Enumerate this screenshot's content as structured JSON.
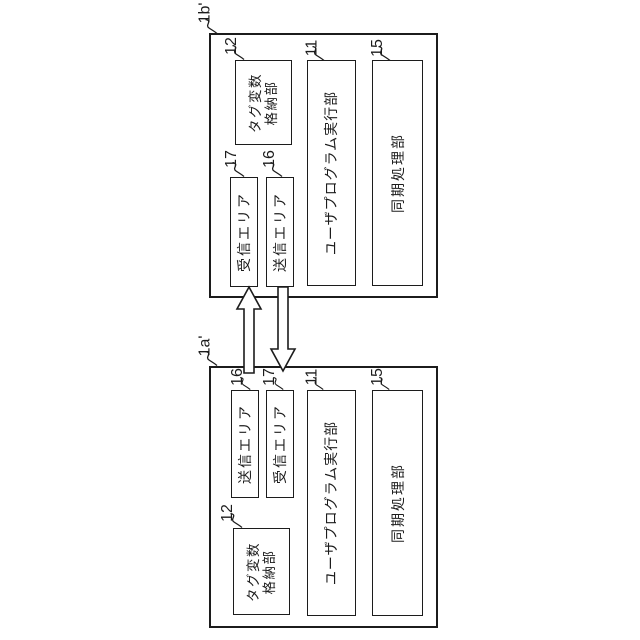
{
  "figure": {
    "type": "patent-block-diagram",
    "background_color": "#ffffff",
    "line_color": "#1c1c1c"
  },
  "systems": [
    {
      "ref_label": "1b'",
      "blocks": {
        "tag_storage": {
          "ref": "12",
          "line1": "タグ変数",
          "line2": "格納部"
        },
        "receive_area": {
          "ref": "17",
          "label": "受信エリア"
        },
        "send_area": {
          "ref": "16",
          "label": "送信エリア"
        },
        "program_exec": {
          "ref": "11",
          "label": "ユーザプログラム実行部"
        },
        "sync_proc": {
          "ref": "15",
          "label": "同期処理部"
        }
      }
    },
    {
      "ref_label": "1a'",
      "blocks": {
        "send_area": {
          "ref": "16",
          "label": "送信エリア"
        },
        "receive_area": {
          "ref": "17",
          "label": "受信エリア"
        },
        "tag_storage": {
          "ref": "12",
          "line1": "タグ変数",
          "line2": "格納部"
        },
        "program_exec": {
          "ref": "11",
          "label": "ユーザプログラム実行部"
        },
        "sync_proc": {
          "ref": "15",
          "label": "同期処理部"
        }
      }
    }
  ],
  "arrows": [
    {
      "name": "send-1a-to-receive-1b",
      "direction": "up"
    },
    {
      "name": "send-1b-to-receive-1a",
      "direction": "down"
    }
  ]
}
